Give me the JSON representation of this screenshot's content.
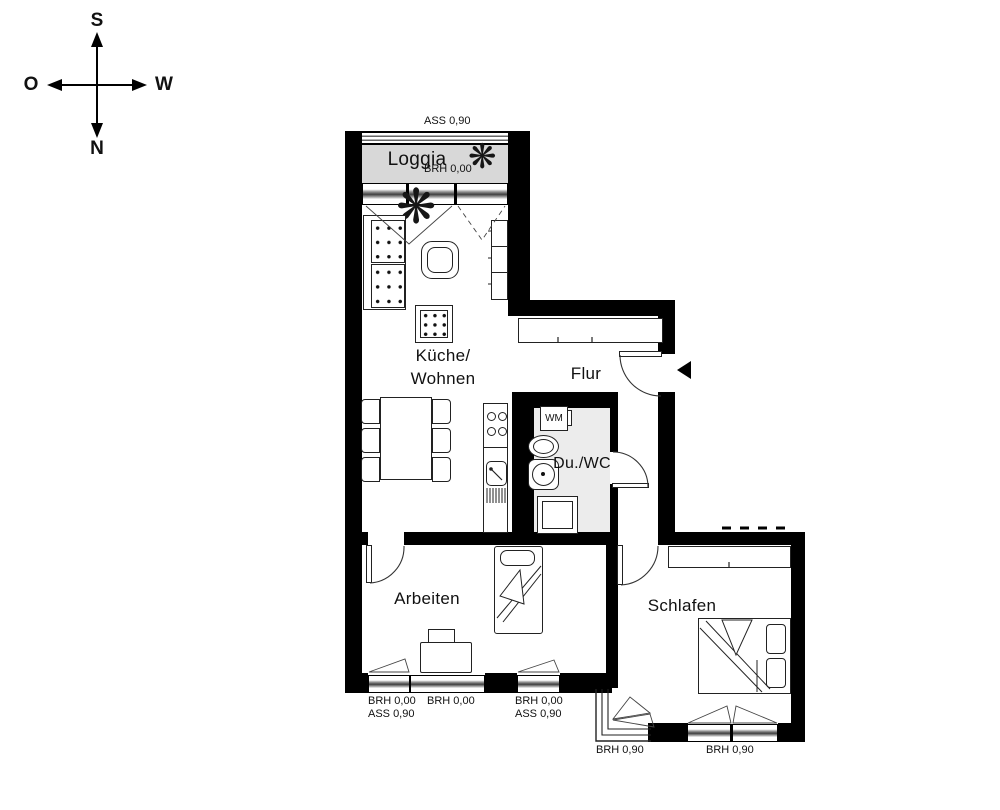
{
  "compass": {
    "south": "S",
    "north": "N",
    "east": "O",
    "west": "W"
  },
  "rooms": {
    "loggia": {
      "name": "Loggia",
      "sill_note": "BRH 0,00",
      "parapet_note": "ASS 0,90"
    },
    "kitchen_living": {
      "name_line1": "Küche/",
      "name_line2": "Wohnen"
    },
    "hallway": {
      "name": "Flur"
    },
    "shower_wc": {
      "name": "Du./WC",
      "washing_machine": "WM"
    },
    "office": {
      "name": "Arbeiten"
    },
    "bedroom": {
      "name": "Schlafen"
    }
  },
  "window_notes": {
    "office_window_left": {
      "line1": "BRH 0,00",
      "line2": "ASS 0,90"
    },
    "office_window_center": {
      "line1": "BRH 0,00"
    },
    "office_window_right": {
      "line1": "BRH 0,00",
      "line2": "ASS 0,90"
    },
    "bedroom_window_corner": {
      "line1": "BRH 0,90"
    },
    "bedroom_window_south": {
      "line1": "BRH 0,90"
    }
  },
  "icons": {
    "plant": "❋"
  },
  "colors": {
    "wall": "#000000",
    "loggia_fill": "#d8d8d8",
    "bathroom_fill": "#ececec",
    "furniture_line": "#222222"
  }
}
